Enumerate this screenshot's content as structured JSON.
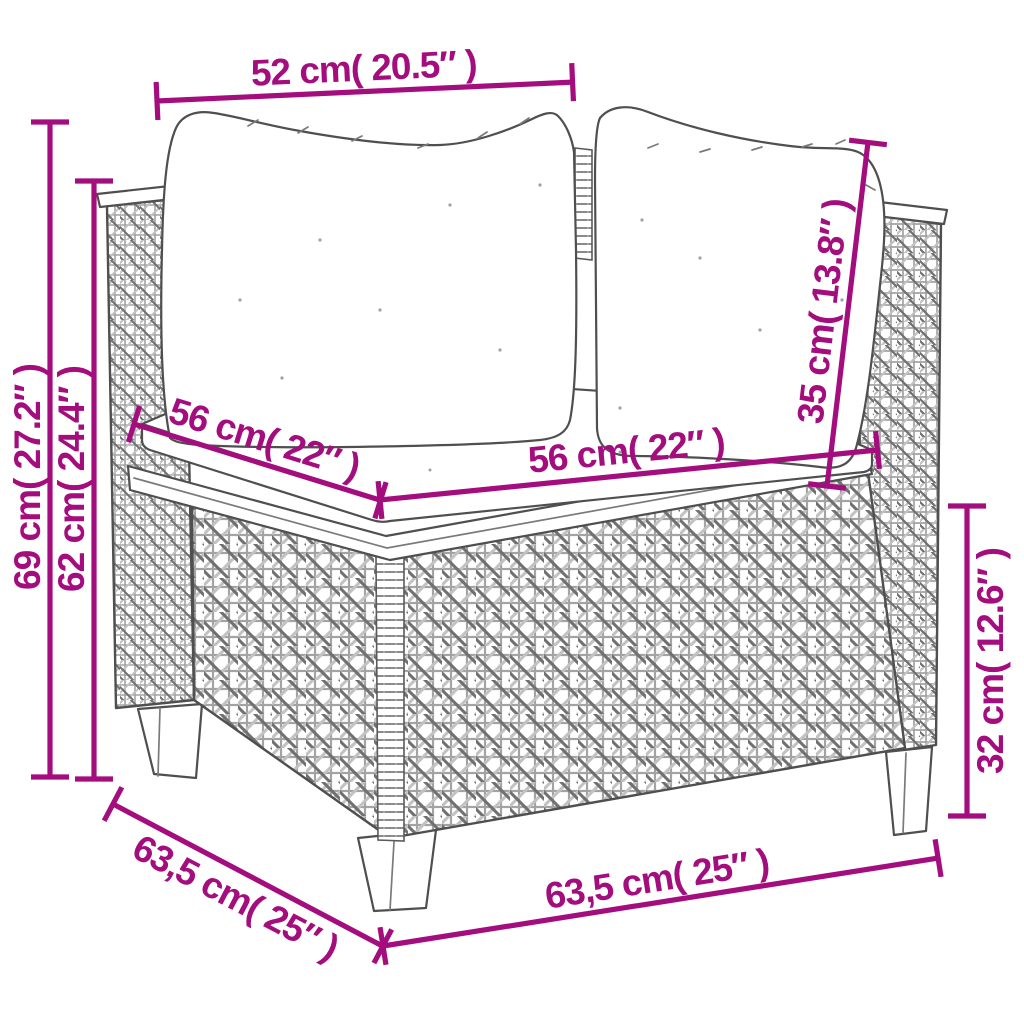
{
  "canvas": {
    "width": 1024,
    "height": 1024,
    "background_color": "#ffffff"
  },
  "colors": {
    "dimension_accent": "#A30D7E",
    "line_art": "#4f4f4f",
    "weave_shadow": "#707070",
    "weave_light": "#c2c2c2"
  },
  "illustration": {
    "alt": "Black-and-white line drawing of a poly rattan wicker corner sofa section with two back cushions, a seat cushion, woven base and four tapered legs"
  },
  "dimensions": {
    "top_width": {
      "label": "52 cm( 20.5″ )"
    },
    "overall_height": {
      "label": "69 cm( 27.2″ )"
    },
    "backrest_height": {
      "label": "62 cm( 24.4″ )"
    },
    "seat_depth": {
      "label": "56 cm( 22″ )"
    },
    "seat_width": {
      "label": "56 cm( 22″ )"
    },
    "back_cushion_height": {
      "label": "35 cm( 13.8″ )"
    },
    "base_height": {
      "label": "32 cm( 12.6″ )"
    },
    "base_depth": {
      "label": "63,5 cm( 25″ )"
    },
    "base_width": {
      "label": "63,5 cm( 25″ )"
    }
  }
}
